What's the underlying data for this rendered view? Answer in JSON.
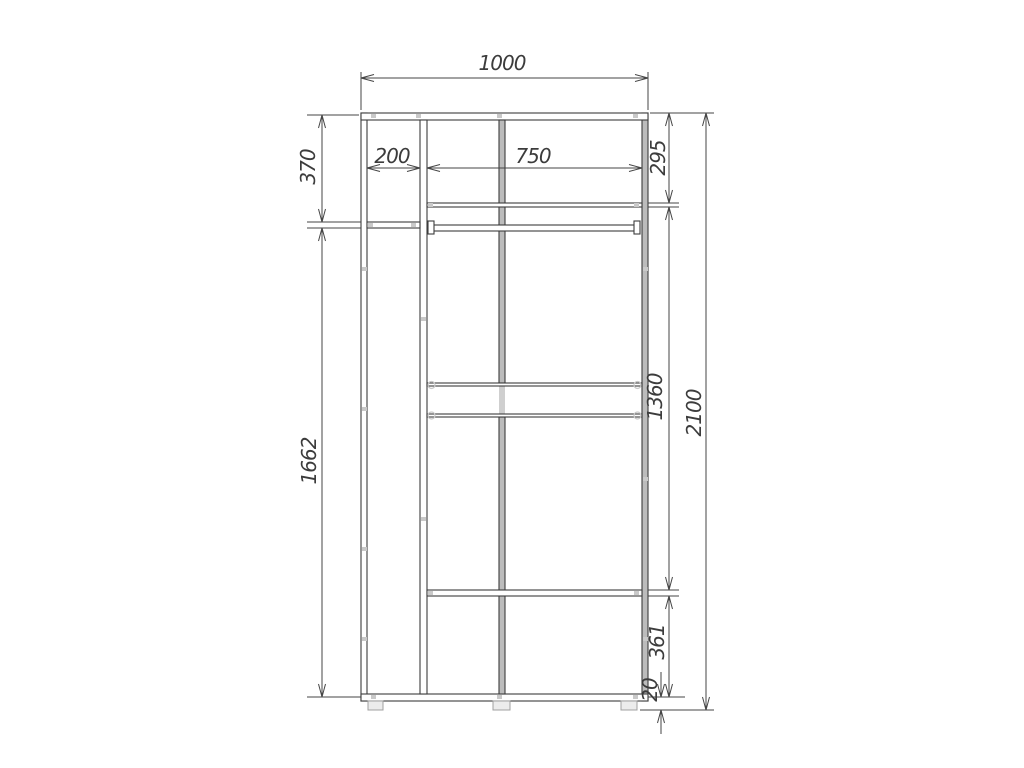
{
  "page": {
    "background_color": "#ffffff"
  },
  "drawing": {
    "type": "technical-dimension-drawing",
    "subject": "wardrobe-front-elevation",
    "line_color": "#3c3c3c",
    "panel_shade_color": "#bcbcbc",
    "hardware_mark_color": "#c9c9c9",
    "dimensions": {
      "overall_width": "1000",
      "overall_height": "2100",
      "left_section_width": "200",
      "right_section_width": "750",
      "left_top_section_height": "370",
      "left_lower_section_height": "1662",
      "right_top_section_height": "295",
      "right_middle_section_height": "1360",
      "right_lower_section_height": "361",
      "base_height": "20"
    }
  }
}
